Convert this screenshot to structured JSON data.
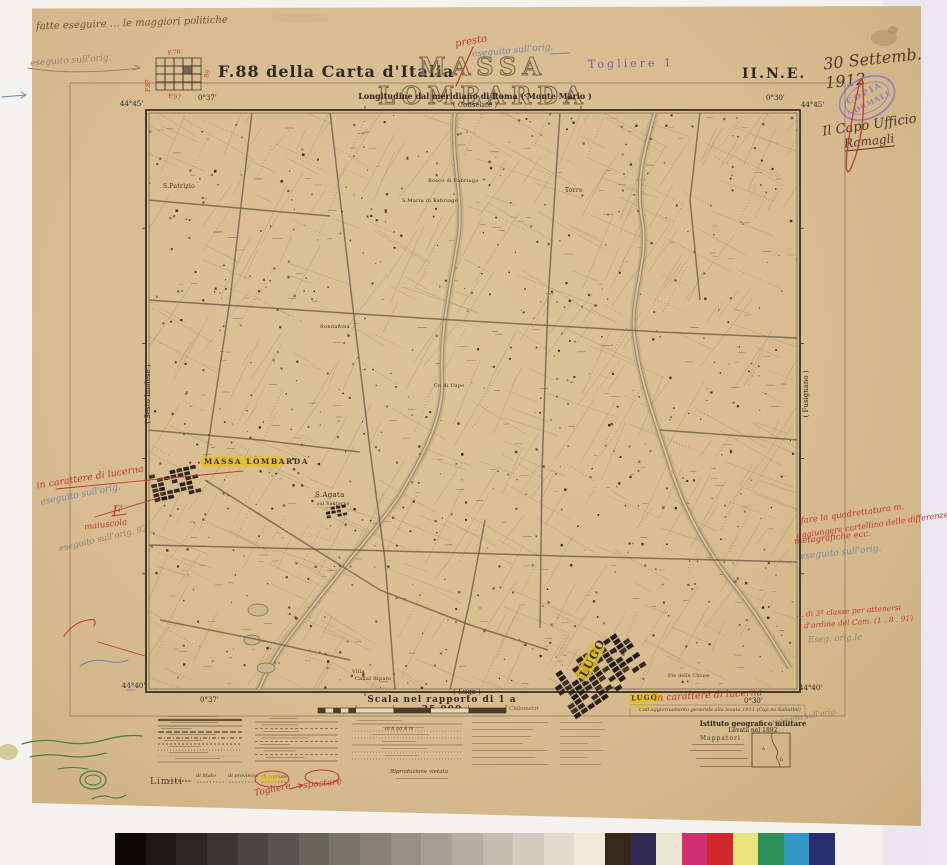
{
  "header": {
    "index_label": "F.88  della Carta d'Italia",
    "title": "MASSA LOMBARDA",
    "quadrant": "II.N.E.",
    "togliere": "Togliere 1",
    "longitude_line": "Longitudine dal meridiano di Roma ( Monte Mario )",
    "index_grid": {
      "top": "F.76",
      "left": "F.87",
      "right": "89",
      "bottom": "F.97"
    }
  },
  "margins": {
    "north_sheet": "( Conselice )",
    "south_sheet": "( Lugo )",
    "west_sheet": "( Sesto Imolese )",
    "east_sheet": "( Fusignano )",
    "corner_coords": {
      "top_left_lat": "44°45'",
      "top_left_lon": "0°37'",
      "top_right_lat": "44°45'",
      "top_right_lon": "0°30'",
      "bottom_left_lat": "44°40'",
      "bottom_left_lon": "0°37'",
      "bottom_right_lat": "44°40'",
      "bottom_right_lon": "0°30'"
    }
  },
  "map_labels": [
    {
      "text": "S.Patrizio",
      "x": 163,
      "y": 188,
      "size": 6,
      "rot": 0,
      "highlight": false
    },
    {
      "text": "Bosco di Fabriago",
      "x": 428,
      "y": 182,
      "size": 5,
      "rot": 0,
      "highlight": false
    },
    {
      "text": "S.Maria di Fabriago",
      "x": 402,
      "y": 202,
      "size": 5,
      "rot": 0,
      "highlight": false
    },
    {
      "text": "Torre",
      "x": 565,
      "y": 192,
      "size": 6,
      "rot": 0,
      "highlight": false
    },
    {
      "text": "Rondanina",
      "x": 320,
      "y": 328,
      "size": 5,
      "rot": 0,
      "highlight": false
    },
    {
      "text": "Co di Lupo",
      "x": 434,
      "y": 387,
      "size": 5,
      "rot": 0,
      "highlight": false
    },
    {
      "text": "MASSA LOMBARDA",
      "x": 204,
      "y": 464,
      "size": 7.5,
      "rot": 0,
      "highlight": true
    },
    {
      "text": "S.Agata",
      "x": 315,
      "y": 497,
      "size": 7,
      "rot": 0,
      "highlight": false
    },
    {
      "text": "sul Santerno",
      "x": 317,
      "y": 505,
      "size": 4.5,
      "rot": 0,
      "highlight": false
    },
    {
      "text": "Villa",
      "x": 352,
      "y": 673,
      "size": 5,
      "rot": 0,
      "highlight": false
    },
    {
      "text": "Canal Ripato",
      "x": 355,
      "y": 680,
      "size": 5,
      "rot": 0,
      "highlight": false
    },
    {
      "text": "Pte delle Chiuse",
      "x": 668,
      "y": 677,
      "size": 4.5,
      "rot": 0,
      "highlight": false
    },
    {
      "text": "LUGO",
      "x": 586,
      "y": 678,
      "size": 11,
      "rot": -62,
      "highlight": true
    }
  ],
  "footer": {
    "scale_text": "Scala nel rapporto di 1 a 25.000",
    "scale_unit": "Chilometri",
    "legend": {
      "limiti_label": "Limiti",
      "items": [
        "di Stato",
        "di provincia",
        "di comune"
      ],
      "width_note": "di 6 ad 8 m",
      "repro_note": "Riproduzione vietata"
    },
    "imprint_line1": "Istituto geografico militare",
    "imprint_line2": "Levata nel 1892",
    "mappatori_label": "Mappatori",
    "update_note": "Coll'aggiornamento generale alla levata 1911 (Cap.no Sabatini)"
  },
  "annotations": {
    "top_note_pencil": "fatte eseguire … le maggiori politiche",
    "arrow_note_pencil": "eseguito sull'orig.",
    "title_note_red": "presto",
    "title_note_blue": "eseguito sull'orig.",
    "date": "30 Settemb. 1912",
    "stamp_line1": "COPIA",
    "stamp_line2": "NORMALE",
    "signature_line1": "Il Capo Ufficio",
    "signature_line2": "Ramagli",
    "left_note_red": "in carattere di lucerna",
    "left_note_blue": "eseguito sull'orig.",
    "left_letter_red": "F",
    "left_word_red": "maiuscola",
    "left_note_pencil": "eseguito sull'orig. 92",
    "right_note_red_1": "fare la quadrettatura m.",
    "right_note_red_2": "aggiungere cartellino delle differenze",
    "right_note_red_3": "metagrafiche ecc.",
    "right_note_blue": "eseguito sull'orig.",
    "right_note2_red_1": "… di 3ª classe per attenersi",
    "right_note2_red_2": "d'ordine del Com. (1 . 8 . 91)",
    "right_note2_pencil": "Eseg. orig.le",
    "lugo_chip": "LUGO",
    "lugo_note_red": "in carattere di lucerna",
    "lugo_note_pencil": "eseguito sull'orig.",
    "legend_note_red_1": "Togliere",
    "legend_note_red_2": "spostare"
  },
  "palette": {
    "paper": "#d8bc90",
    "ink": "#3a2f22",
    "annotation_red": "#bf3a28",
    "annotation_blue": "#7886a6",
    "annotation_green": "#4a7c46",
    "highlight_yellow": "#e3bf2b",
    "stamp_purple": "#8d80c2",
    "town_black": "#1d1710"
  },
  "calibration": {
    "gray_steps": 16,
    "gray_start": "#0b0a09",
    "gray_end": "#f0ead9",
    "colors": [
      "#35291a",
      "#322c55",
      "#ece5d2",
      "#cf2e73",
      "#d0292b",
      "#eae27d",
      "#2c9057",
      "#3398c6",
      "#292e71"
    ]
  }
}
